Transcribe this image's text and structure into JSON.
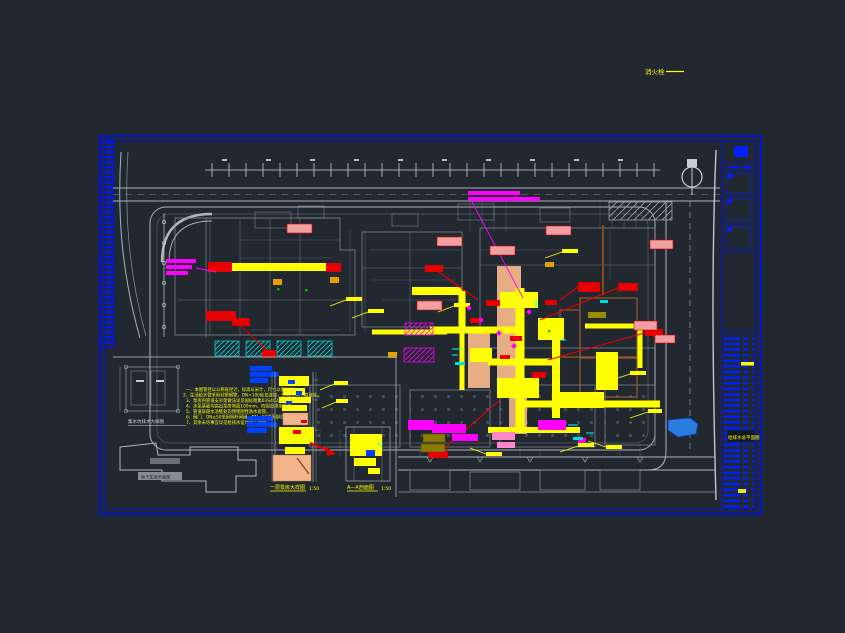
{
  "meta": {
    "type": "CAD site utility plan (plumbing / drainage general layout)",
    "background": "#212830"
  },
  "palette": {
    "frame_blue": "#0010ee",
    "line_gray": "#aab2ba",
    "bright_gray": "#c8ccd2",
    "pipe_yellow": "#ffff00",
    "salmon": "#f2b488",
    "red": "#e80000",
    "magenta": "#ff00ff",
    "cyan": "#00e0e0",
    "callout_blue": "#0040ff",
    "brown": "#9a5b2e",
    "olive": "#8f7a00",
    "pond_blue": "#2b7de0"
  },
  "top_note": {
    "text": "消火栓",
    "underline": "——"
  },
  "labels": {
    "sump_detail": "集水坑排水大样图",
    "footprint": "地下车库平面图",
    "pump_room": "一层泵房大样图",
    "pump_room_scale": "1:50",
    "section": "A—A剖面图",
    "section_scale": "1:50"
  },
  "notes": {
    "lines": [
      "一、本图管径以公称直径计，标高以米计，尺寸以毫米计。",
      "2、生活给水管采用衬塑钢管，DN<100丝扣连接，DN≥100卡箍连接。",
      "3、泵房内管道支吊架做法详见国标图集03S402。",
      "4、水泵基础均高出泵房地面100mm，四周设排水明沟。",
      "5、管道穿越水池壁处均预埋刚性防水套管。",
      "6、阀门：DN≥50采用明杆闸阀，DN<50采用铜质截止阀。",
      "7、其余未尽事宜详见给排水设计施工说明。"
    ]
  },
  "title_block": {
    "highlight_row": "给排水总平面图"
  }
}
